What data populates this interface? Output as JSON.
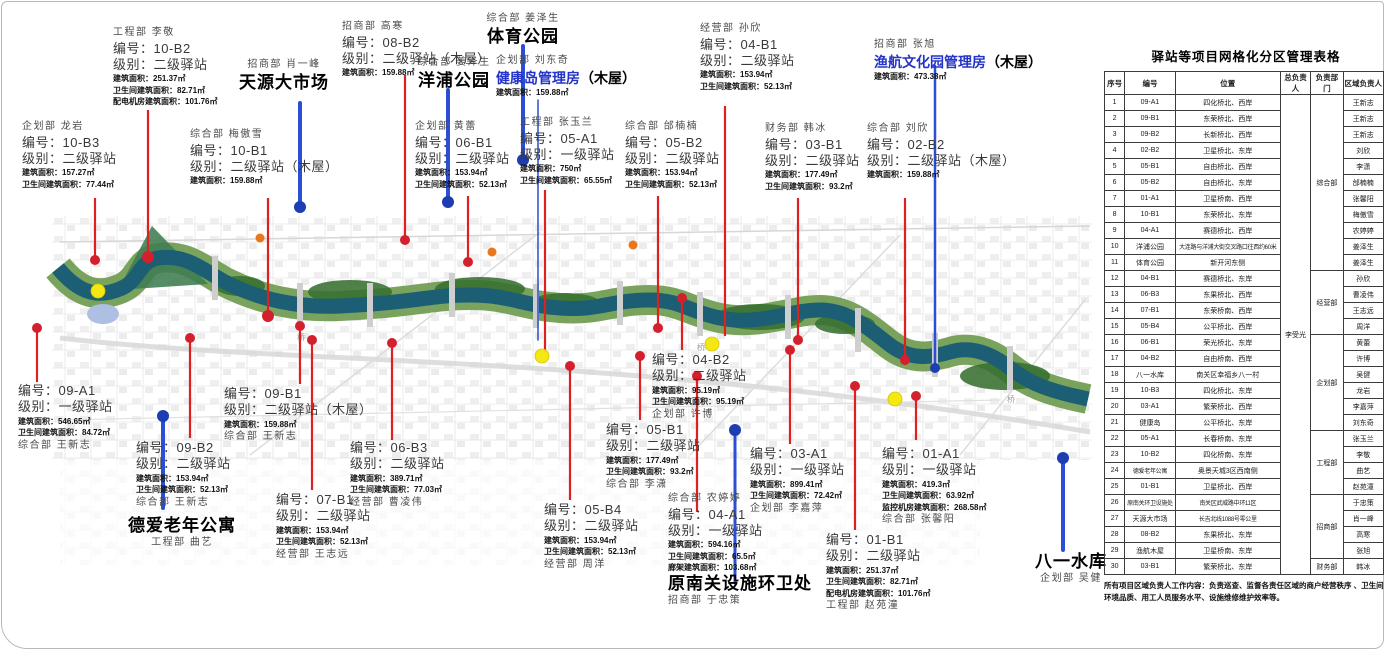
{
  "map": {
    "bridge_label": "桥"
  },
  "callouts": [
    {
      "id": "10b2",
      "lines": [
        {
          "text": "工程部  李敬",
          "style": "dept"
        },
        {
          "text": "编号：10-B2",
          "style": "code"
        },
        {
          "text": "级别：二级驿站",
          "style": "level"
        },
        {
          "text": "建筑面积：251.37㎡",
          "style": "detail"
        },
        {
          "text": "卫生间建筑面积：82.71㎡",
          "style": "detail"
        },
        {
          "text": "配电机房建筑面积：101.76㎡",
          "style": "detail"
        }
      ]
    },
    {
      "id": "tianyuan",
      "center": true,
      "lines": [
        {
          "text": "招商部  肖一峰",
          "style": "dept"
        },
        {
          "text": "天源大市场",
          "style": "name"
        }
      ]
    },
    {
      "id": "08b2",
      "lines": [
        {
          "text": "招商部  高寒",
          "style": "dept"
        },
        {
          "text": "编号：08-B2",
          "style": "code"
        },
        {
          "text": "级别：二级驿站（木屋）",
          "style": "level"
        },
        {
          "text": "建筑面积：159.88㎡",
          "style": "detail"
        }
      ]
    },
    {
      "id": "yangpu",
      "center": true,
      "lines": [
        {
          "text": "综合部  姜泽生",
          "style": "dept"
        },
        {
          "text": "洋浦公园",
          "style": "name"
        }
      ]
    },
    {
      "id": "tiyu",
      "center": true,
      "lines": [
        {
          "text": "综合部  姜泽生",
          "style": "dept"
        },
        {
          "text": "体育公园",
          "style": "name"
        }
      ]
    },
    {
      "id": "jiankang",
      "lines": [
        {
          "text": "企划部  刘东奇",
          "style": "dept"
        },
        {
          "text": "健康岛管理房",
          "style": "nameblue",
          "suffix": "（木屋）"
        },
        {
          "text": "建筑面积：159.88㎡",
          "style": "detail"
        }
      ]
    },
    {
      "id": "04b1",
      "lines": [
        {
          "text": "经营部  孙欣",
          "style": "dept"
        },
        {
          "text": "编号：04-B1",
          "style": "code"
        },
        {
          "text": "级别：二级驿站",
          "style": "level"
        },
        {
          "text": "建筑面积：153.94㎡",
          "style": "detail"
        },
        {
          "text": "卫生间建筑面积：52.13㎡",
          "style": "detail"
        }
      ]
    },
    {
      "id": "yuhang",
      "lines": [
        {
          "text": "招商部  张旭",
          "style": "dept"
        },
        {
          "text": "渔航文化园管理房",
          "style": "nameblue",
          "suffix": "（木屋）"
        },
        {
          "text": "建筑面积：473.38㎡",
          "style": "detail"
        }
      ]
    },
    {
      "id": "10b3",
      "lines": [
        {
          "text": "企划部  龙岩",
          "style": "dept"
        },
        {
          "text": "编号：10-B3",
          "style": "code"
        },
        {
          "text": "级别：二级驿站",
          "style": "level"
        },
        {
          "text": "建筑面积：157.27㎡",
          "style": "detail"
        },
        {
          "text": "卫生间建筑面积：77.44㎡",
          "style": "detail"
        }
      ]
    },
    {
      "id": "10b1",
      "lines": [
        {
          "text": "综合部  梅傲雪",
          "style": "dept"
        },
        {
          "text": "编号：10-B1",
          "style": "code"
        },
        {
          "text": "级别：二级驿站（木屋）",
          "style": "level"
        },
        {
          "text": "建筑面积：159.88㎡",
          "style": "detail"
        }
      ]
    },
    {
      "id": "06b1",
      "lines": [
        {
          "text": "企划部  黄蕾",
          "style": "dept"
        },
        {
          "text": "编号：06-B1",
          "style": "code"
        },
        {
          "text": "级别：二级驿站",
          "style": "level"
        },
        {
          "text": "建筑面积：153.94㎡",
          "style": "detail"
        },
        {
          "text": "卫生间建筑面积：52.13㎡",
          "style": "detail"
        }
      ]
    },
    {
      "id": "05a1",
      "lines": [
        {
          "text": "工程部  张玉兰",
          "style": "dept"
        },
        {
          "text": "编号：05-A1",
          "style": "code"
        },
        {
          "text": "级别：一级驿站",
          "style": "level"
        },
        {
          "text": "建筑面积：750㎡",
          "style": "detail"
        },
        {
          "text": "卫生间建筑面积：65.55㎡",
          "style": "detail"
        }
      ]
    },
    {
      "id": "05b2",
      "lines": [
        {
          "text": "综合部  邰楠楠",
          "style": "dept"
        },
        {
          "text": "编号：05-B2",
          "style": "code"
        },
        {
          "text": "级别：二级驿站",
          "style": "level"
        },
        {
          "text": "建筑面积：153.94㎡",
          "style": "detail"
        },
        {
          "text": "卫生间建筑面积：52.13㎡",
          "style": "detail"
        }
      ]
    },
    {
      "id": "03b1",
      "lines": [
        {
          "text": "财务部  韩冰",
          "style": "dept"
        },
        {
          "text": "编号：03-B1",
          "style": "code"
        },
        {
          "text": "级别：二级驿站",
          "style": "level"
        },
        {
          "text": "建筑面积：177.49㎡",
          "style": "detail"
        },
        {
          "text": "卫生间建筑面积：93.2㎡",
          "style": "detail"
        }
      ]
    },
    {
      "id": "02b2",
      "lines": [
        {
          "text": "综合部  刘欣",
          "style": "dept"
        },
        {
          "text": "编号：02-B2",
          "style": "code"
        },
        {
          "text": "级别：二级驿站（木屋）",
          "style": "level"
        },
        {
          "text": "建筑面积：159.88㎡",
          "style": "detail"
        }
      ]
    },
    {
      "id": "09a1",
      "lines": [
        {
          "text": "编号：09-A1",
          "style": "code"
        },
        {
          "text": "级别：一级驿站",
          "style": "level"
        },
        {
          "text": "建筑面积：546.65㎡",
          "style": "detail"
        },
        {
          "text": "卫生间建筑面积：84.72㎡",
          "style": "detail"
        },
        {
          "text": "综合部  王新志",
          "style": "dept"
        }
      ]
    },
    {
      "id": "09b2",
      "lines": [
        {
          "text": "编号：09-B2",
          "style": "code"
        },
        {
          "text": "级别：二级驿站",
          "style": "level"
        },
        {
          "text": "建筑面积：153.94㎡",
          "style": "detail"
        },
        {
          "text": "卫生间建筑面积：52.13㎡",
          "style": "detail"
        },
        {
          "text": "综合部  王新志",
          "style": "dept"
        }
      ]
    },
    {
      "id": "deai",
      "center": true,
      "lines": [
        {
          "text": "德爱老年公寓",
          "style": "name"
        },
        {
          "text": "工程部  曲艺",
          "style": "dept"
        }
      ]
    },
    {
      "id": "09b1",
      "lines": [
        {
          "text": "编号：09-B1",
          "style": "code"
        },
        {
          "text": "级别：二级驿站（木屋）",
          "style": "level"
        },
        {
          "text": "建筑面积：159.88㎡",
          "style": "detail"
        },
        {
          "text": "综合部  王新志",
          "style": "dept"
        }
      ]
    },
    {
      "id": "07b1",
      "lines": [
        {
          "text": "编号：07-B1",
          "style": "code"
        },
        {
          "text": "级别：二级驿站",
          "style": "level"
        },
        {
          "text": "建筑面积：153.94㎡",
          "style": "detail"
        },
        {
          "text": "卫生间建筑面积：52.13㎡",
          "style": "detail"
        },
        {
          "text": "经营部  王志远",
          "style": "dept"
        }
      ]
    },
    {
      "id": "06b3",
      "lines": [
        {
          "text": "编号：06-B3",
          "style": "code"
        },
        {
          "text": "级别：二级驿站",
          "style": "level"
        },
        {
          "text": "建筑面积：389.71㎡",
          "style": "detail"
        },
        {
          "text": "卫生间建筑面积：77.03㎡",
          "style": "detail"
        },
        {
          "text": "经营部  曹凌伟",
          "style": "dept"
        }
      ]
    },
    {
      "id": "05b4",
      "lines": [
        {
          "text": "编号：05-B4",
          "style": "code"
        },
        {
          "text": "级别：二级驿站",
          "style": "level"
        },
        {
          "text": "建筑面积：153.94㎡",
          "style": "detail"
        },
        {
          "text": "卫生间建筑面积：52.13㎡",
          "style": "detail"
        },
        {
          "text": "经营部  周洋",
          "style": "dept"
        }
      ]
    },
    {
      "id": "05b1",
      "lines": [
        {
          "text": "编号：05-B1",
          "style": "code"
        },
        {
          "text": "级别：二级驿站",
          "style": "level"
        },
        {
          "text": "建筑面积：177.49㎡",
          "style": "detail"
        },
        {
          "text": "卫生间建筑面积：93.2㎡",
          "style": "detail"
        },
        {
          "text": "综合部  李潇",
          "style": "dept"
        }
      ]
    },
    {
      "id": "04b2",
      "lines": [
        {
          "text": "编号：04-B2",
          "style": "code"
        },
        {
          "text": "级别：二级驿站",
          "style": "level"
        },
        {
          "text": "建筑面积：95.19㎡",
          "style": "detail"
        },
        {
          "text": "卫生间建筑面积：95.19㎡",
          "style": "detail"
        },
        {
          "text": "企划部  许博",
          "style": "dept"
        }
      ]
    },
    {
      "id": "04a1",
      "lines": [
        {
          "text": "综合部  农婷婷",
          "style": "dept"
        },
        {
          "text": "编号：04-A1",
          "style": "code"
        },
        {
          "text": "级别：一级驿站",
          "style": "level"
        },
        {
          "text": "建筑面积：594.16㎡",
          "style": "detail"
        },
        {
          "text": "卫生间建筑面积：65.5㎡",
          "style": "detail"
        },
        {
          "text": "廊架建筑面积：103.68㎡",
          "style": "detail"
        },
        {
          "text": "原南关设施环卫处",
          "style": "name"
        },
        {
          "text": "招商部  于忠策",
          "style": "dept"
        }
      ]
    },
    {
      "id": "03a1",
      "lines": [
        {
          "text": "编号：03-A1",
          "style": "code"
        },
        {
          "text": "级别：一级驿站",
          "style": "level"
        },
        {
          "text": "建筑面积：899.41㎡",
          "style": "detail"
        },
        {
          "text": "卫生间建筑面积：72.42㎡",
          "style": "detail"
        },
        {
          "text": "企划部  李嘉萍",
          "style": "dept"
        }
      ]
    },
    {
      "id": "01b1",
      "lines": [
        {
          "text": "编号：01-B1",
          "style": "code"
        },
        {
          "text": "级别：二级驿站",
          "style": "level"
        },
        {
          "text": "建筑面积：251.37㎡",
          "style": "detail"
        },
        {
          "text": "卫生间建筑面积：82.71㎡",
          "style": "detail"
        },
        {
          "text": "配电机房建筑面积：101.76㎡",
          "style": "detail"
        },
        {
          "text": "工程部  赵苑潼",
          "style": "dept"
        }
      ]
    },
    {
      "id": "01a1",
      "lines": [
        {
          "text": "编号：01-A1",
          "style": "code"
        },
        {
          "text": "级别：一级驿站",
          "style": "level"
        },
        {
          "text": "建筑面积：419.3㎡",
          "style": "detail"
        },
        {
          "text": "卫生间建筑面积：63.92㎡",
          "style": "detail"
        },
        {
          "text": "监控机房建筑面积：268.58㎡",
          "style": "detail"
        },
        {
          "text": "综合部  张馨阳",
          "style": "dept"
        }
      ]
    },
    {
      "id": "bayi",
      "center": true,
      "lines": [
        {
          "text": "八一水库",
          "style": "name"
        },
        {
          "text": "企划部  吴健",
          "style": "dept"
        }
      ]
    }
  ],
  "table": {
    "title": "驿站等项目网格化分区管理表格",
    "headers": [
      "序号",
      "编号",
      "位置",
      "总负责人",
      "负责部门",
      "区域负责人"
    ],
    "overall_manager": "李受光",
    "dept_groups": [
      {
        "name": "综合部",
        "rows": 11
      },
      {
        "name": "经营部",
        "rows": 4
      },
      {
        "name": "企划部",
        "rows": 6
      },
      {
        "name": "工程部",
        "rows": 4
      },
      {
        "name": "招商部",
        "rows": 4
      },
      {
        "name": "财务部",
        "rows": 1
      }
    ],
    "rows": [
      {
        "no": "1",
        "code": "09-A1",
        "location": "四化桥北、西岸",
        "region_manager": "王新志"
      },
      {
        "no": "2",
        "code": "09-B1",
        "location": "东荣桥北、西岸",
        "region_manager": "王新志"
      },
      {
        "no": "3",
        "code": "09-B2",
        "location": "长新桥北、西岸",
        "region_manager": "王新志"
      },
      {
        "no": "4",
        "code": "02-B2",
        "location": "卫星桥北、东岸",
        "region_manager": "刘欣"
      },
      {
        "no": "5",
        "code": "05-B1",
        "location": "自由桥北、西岸",
        "region_manager": "李潇"
      },
      {
        "no": "6",
        "code": "05-B2",
        "location": "自由桥北、东岸",
        "region_manager": "邰楠楠"
      },
      {
        "no": "7",
        "code": "01-A1",
        "location": "卫星桥南、西岸",
        "region_manager": "张馨阳"
      },
      {
        "no": "8",
        "code": "10-B1",
        "location": "东荣桥北、东岸",
        "region_manager": "梅傲雪"
      },
      {
        "no": "9",
        "code": "04-A1",
        "location": "赛德桥北、西岸",
        "region_manager": "农婷婷"
      },
      {
        "no": "10",
        "code": "洋浦公园",
        "location": "大连路与洋浦大街交叉路口往西约60米",
        "region_manager": "姜泽生"
      },
      {
        "no": "11",
        "code": "体育公园",
        "location": "新开河东侧",
        "region_manager": "姜泽生"
      },
      {
        "no": "12",
        "code": "04-B1",
        "location": "赛德桥北、东岸",
        "region_manager": "孙欣"
      },
      {
        "no": "13",
        "code": "06-B3",
        "location": "东果桥北、西岸",
        "region_manager": "曹凌伟"
      },
      {
        "no": "14",
        "code": "07-B1",
        "location": "东荣桥南、西岸",
        "region_manager": "王志远"
      },
      {
        "no": "15",
        "code": "05-B4",
        "location": "公平桥北、西岸",
        "region_manager": "周洋"
      },
      {
        "no": "16",
        "code": "06-B1",
        "location": "荣光桥北、东岸",
        "region_manager": "黄蕾"
      },
      {
        "no": "17",
        "code": "04-B2",
        "location": "自由桥南、西岸",
        "region_manager": "许博"
      },
      {
        "no": "18",
        "code": "八一水库",
        "location": "南关区幸福乡八一村",
        "region_manager": "吴健"
      },
      {
        "no": "19",
        "code": "10-B3",
        "location": "四化桥北、东岸",
        "region_manager": "龙岩"
      },
      {
        "no": "20",
        "code": "03-A1",
        "location": "繁荣桥北、西岸",
        "region_manager": "李嘉萍"
      },
      {
        "no": "21",
        "code": "健康岛",
        "location": "公平桥北、东岸",
        "region_manager": "刘东奇"
      },
      {
        "no": "22",
        "code": "05-A1",
        "location": "长春桥南、东岸",
        "region_manager": "张玉兰"
      },
      {
        "no": "23",
        "code": "10-B2",
        "location": "四化桥南、东岸",
        "region_manager": "李敬"
      },
      {
        "no": "24",
        "code": "德爱老年公寓",
        "location": "奥景天城3区西南侧",
        "region_manager": "曲艺"
      },
      {
        "no": "25",
        "code": "01-B1",
        "location": "卫星桥北、西岸",
        "region_manager": "赵苑潼"
      },
      {
        "no": "26",
        "code": "原南关环卫设施处",
        "location": "南关区武威路中环11区",
        "region_manager": "于忠策"
      },
      {
        "no": "27",
        "code": "天源大市场",
        "location": "长吉北线1088号零公里",
        "region_manager": "肖一峰"
      },
      {
        "no": "28",
        "code": "08-B2",
        "location": "东果桥北、东岸",
        "region_manager": "高寒"
      },
      {
        "no": "29",
        "code": "渔航木屋",
        "location": "卫星桥南、东岸",
        "region_manager": "张旭"
      },
      {
        "no": "30",
        "code": "03-B1",
        "location": "繁荣桥北、东岸",
        "region_manager": "韩冰"
      }
    ],
    "footnote": "所有项目区域负责人工作内容：负责巡查、监督各责任区域的商户经营秩序 、卫生间环境品质、用工人员服务水平、设施维修维护效率等。"
  }
}
